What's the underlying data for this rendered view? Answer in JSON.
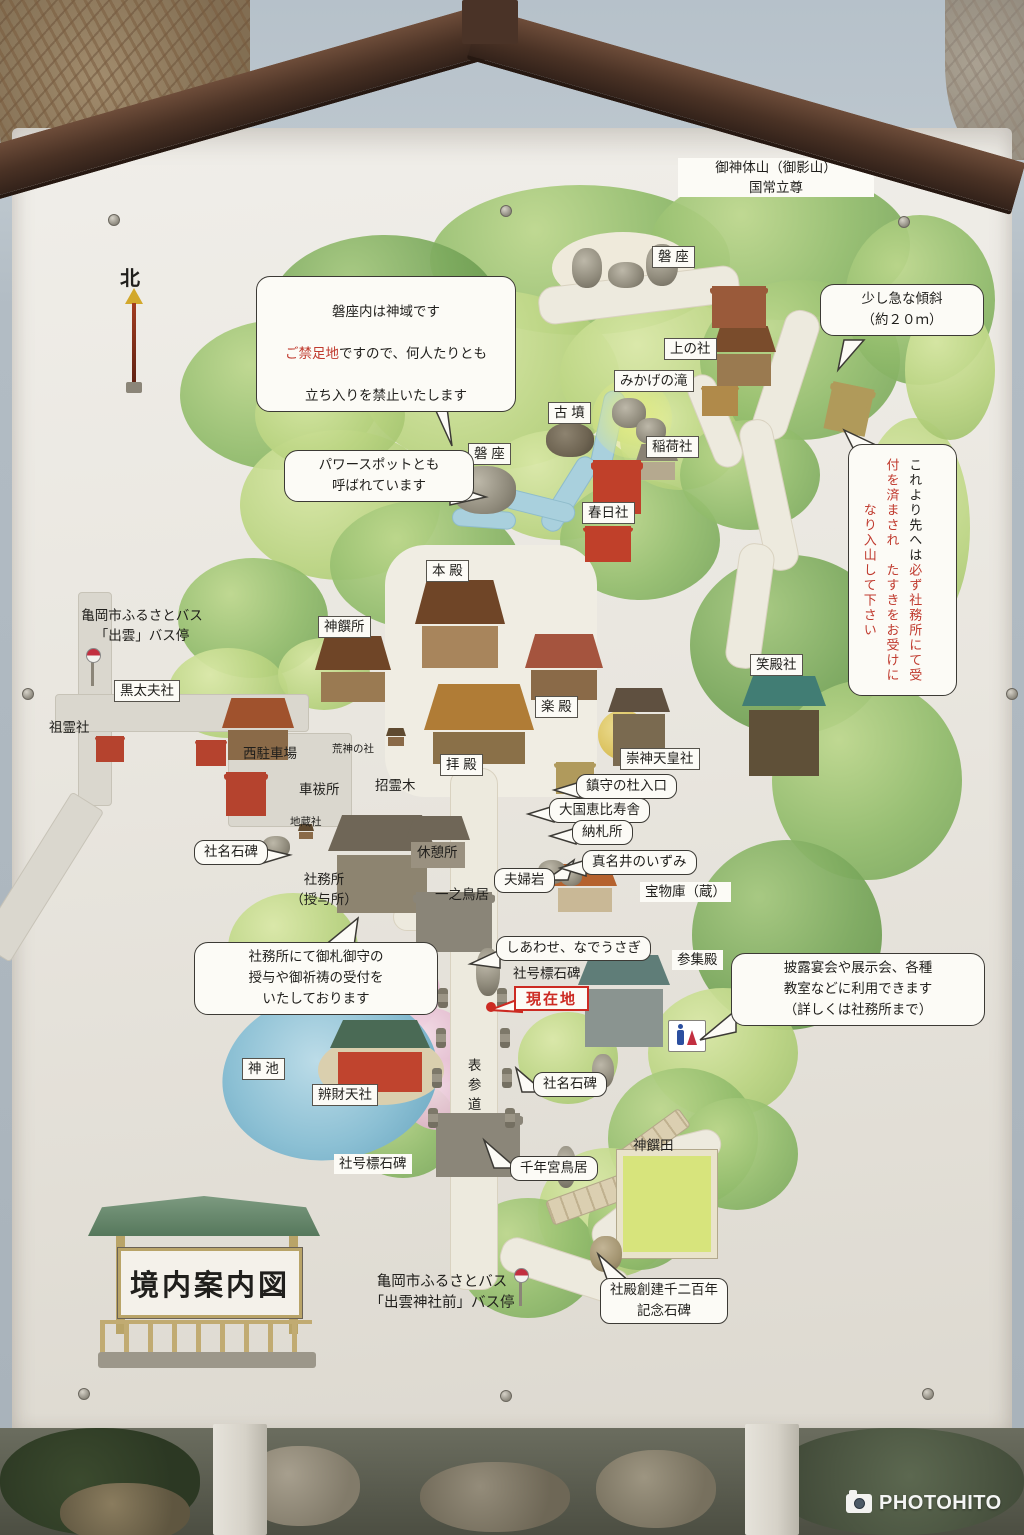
{
  "photo": {
    "watermark": "PHOTOHITO",
    "icons": {
      "camera": "camera-icon",
      "restroom": "restroom-icon",
      "bus_stop": "bus-stop-icon",
      "north_arrow": "north-arrow-icon"
    }
  },
  "sign": {
    "title": "境内案内図",
    "north": "北",
    "summit": "御神体山（御影山）\n国常立尊",
    "colors": {
      "notice_red": "#c03a2e",
      "current_location_red": "#cc2a22"
    },
    "labels": {
      "iwakura_upper": "磐 座",
      "iwakura_lower": "磐 座",
      "kaminoyashiro": "上の社",
      "mikage_falls": "みかげの滝",
      "kofun": "古 墳",
      "inarisha": "稲荷社",
      "kasugasha": "春日社",
      "honden": "本 殿",
      "shinsensho": "神饌所",
      "gakuden": "楽 殿",
      "emidonosha": "笑殿社",
      "sujintennosha": "崇神天皇社",
      "haiden": "拝 殿",
      "kurotayusha": "黒太夫社",
      "soreisha": "祖霊社",
      "bus_stop_izumo": "亀岡市ふるさとバス\n「出雲」バス停",
      "nishi_parking": "西駐車場",
      "kojin_no_yashiro": "荒神の社",
      "kurumaharaisho": "車祓所",
      "ogatamanoki": "招霊木",
      "jizosha": "地蔵社",
      "kyukeisho": "休憩所",
      "shamusho": "社務所\n（授与所）",
      "ichino_torii": "一之鳥居",
      "homotsuko": "宝物庫（蔵）",
      "sanshuden": "参集殿",
      "shago_hyo_center": "社号標石碑",
      "genzaichi": "現在地",
      "shinike": "神 池",
      "benzaitensha": "辨財天社",
      "omote_sando": "表参道",
      "shago_hyo_lower": "社号標石碑",
      "shinsenden": "神饌田",
      "bus_stop_izumo_jinja_mae": "亀岡市ふるさとバス\n「出雲神社前」バス停"
    },
    "callouts": {
      "iwakura_notice": {
        "line1": "磐座内は神域です",
        "red": "ご禁足地",
        "line2": "ですので、何人たりとも",
        "line3": "立ち入りを禁止いたします"
      },
      "power_spot": "パワースポットとも\n呼ばれています",
      "slope": "少し急な傾斜\n（約２０ｍ）",
      "reception": {
        "black": "これより先へは",
        "red": "必ず社務所にて受付を済まされ　たすきをお受けになり入山して下さい"
      },
      "chinju_entrance": "鎮守の杜入口",
      "daikoku_ebisu": "大国恵比寿舎",
      "nosatsusho": "納札所",
      "manai_spring": "真名井のいずみ",
      "meotoiwa": "夫婦岩",
      "shamei_sekihi_upper": "社名石碑",
      "shiawase_nadeusagi": "しあわせ、なでうさぎ",
      "shamei_sekihi_lower": "社名石碑",
      "sennengu_torii": "千年宮鳥居",
      "shamusho_note": "社務所にて御札御守の\n授与や御祈祷の受付を\nいたしております",
      "sanshuden_note": "披露宴会や展示会、各種\n教室などに利用できます\n（詳しくは社務所まで）",
      "kinen_sekihi": "社殿創建千二百年\n記念石碑"
    }
  }
}
